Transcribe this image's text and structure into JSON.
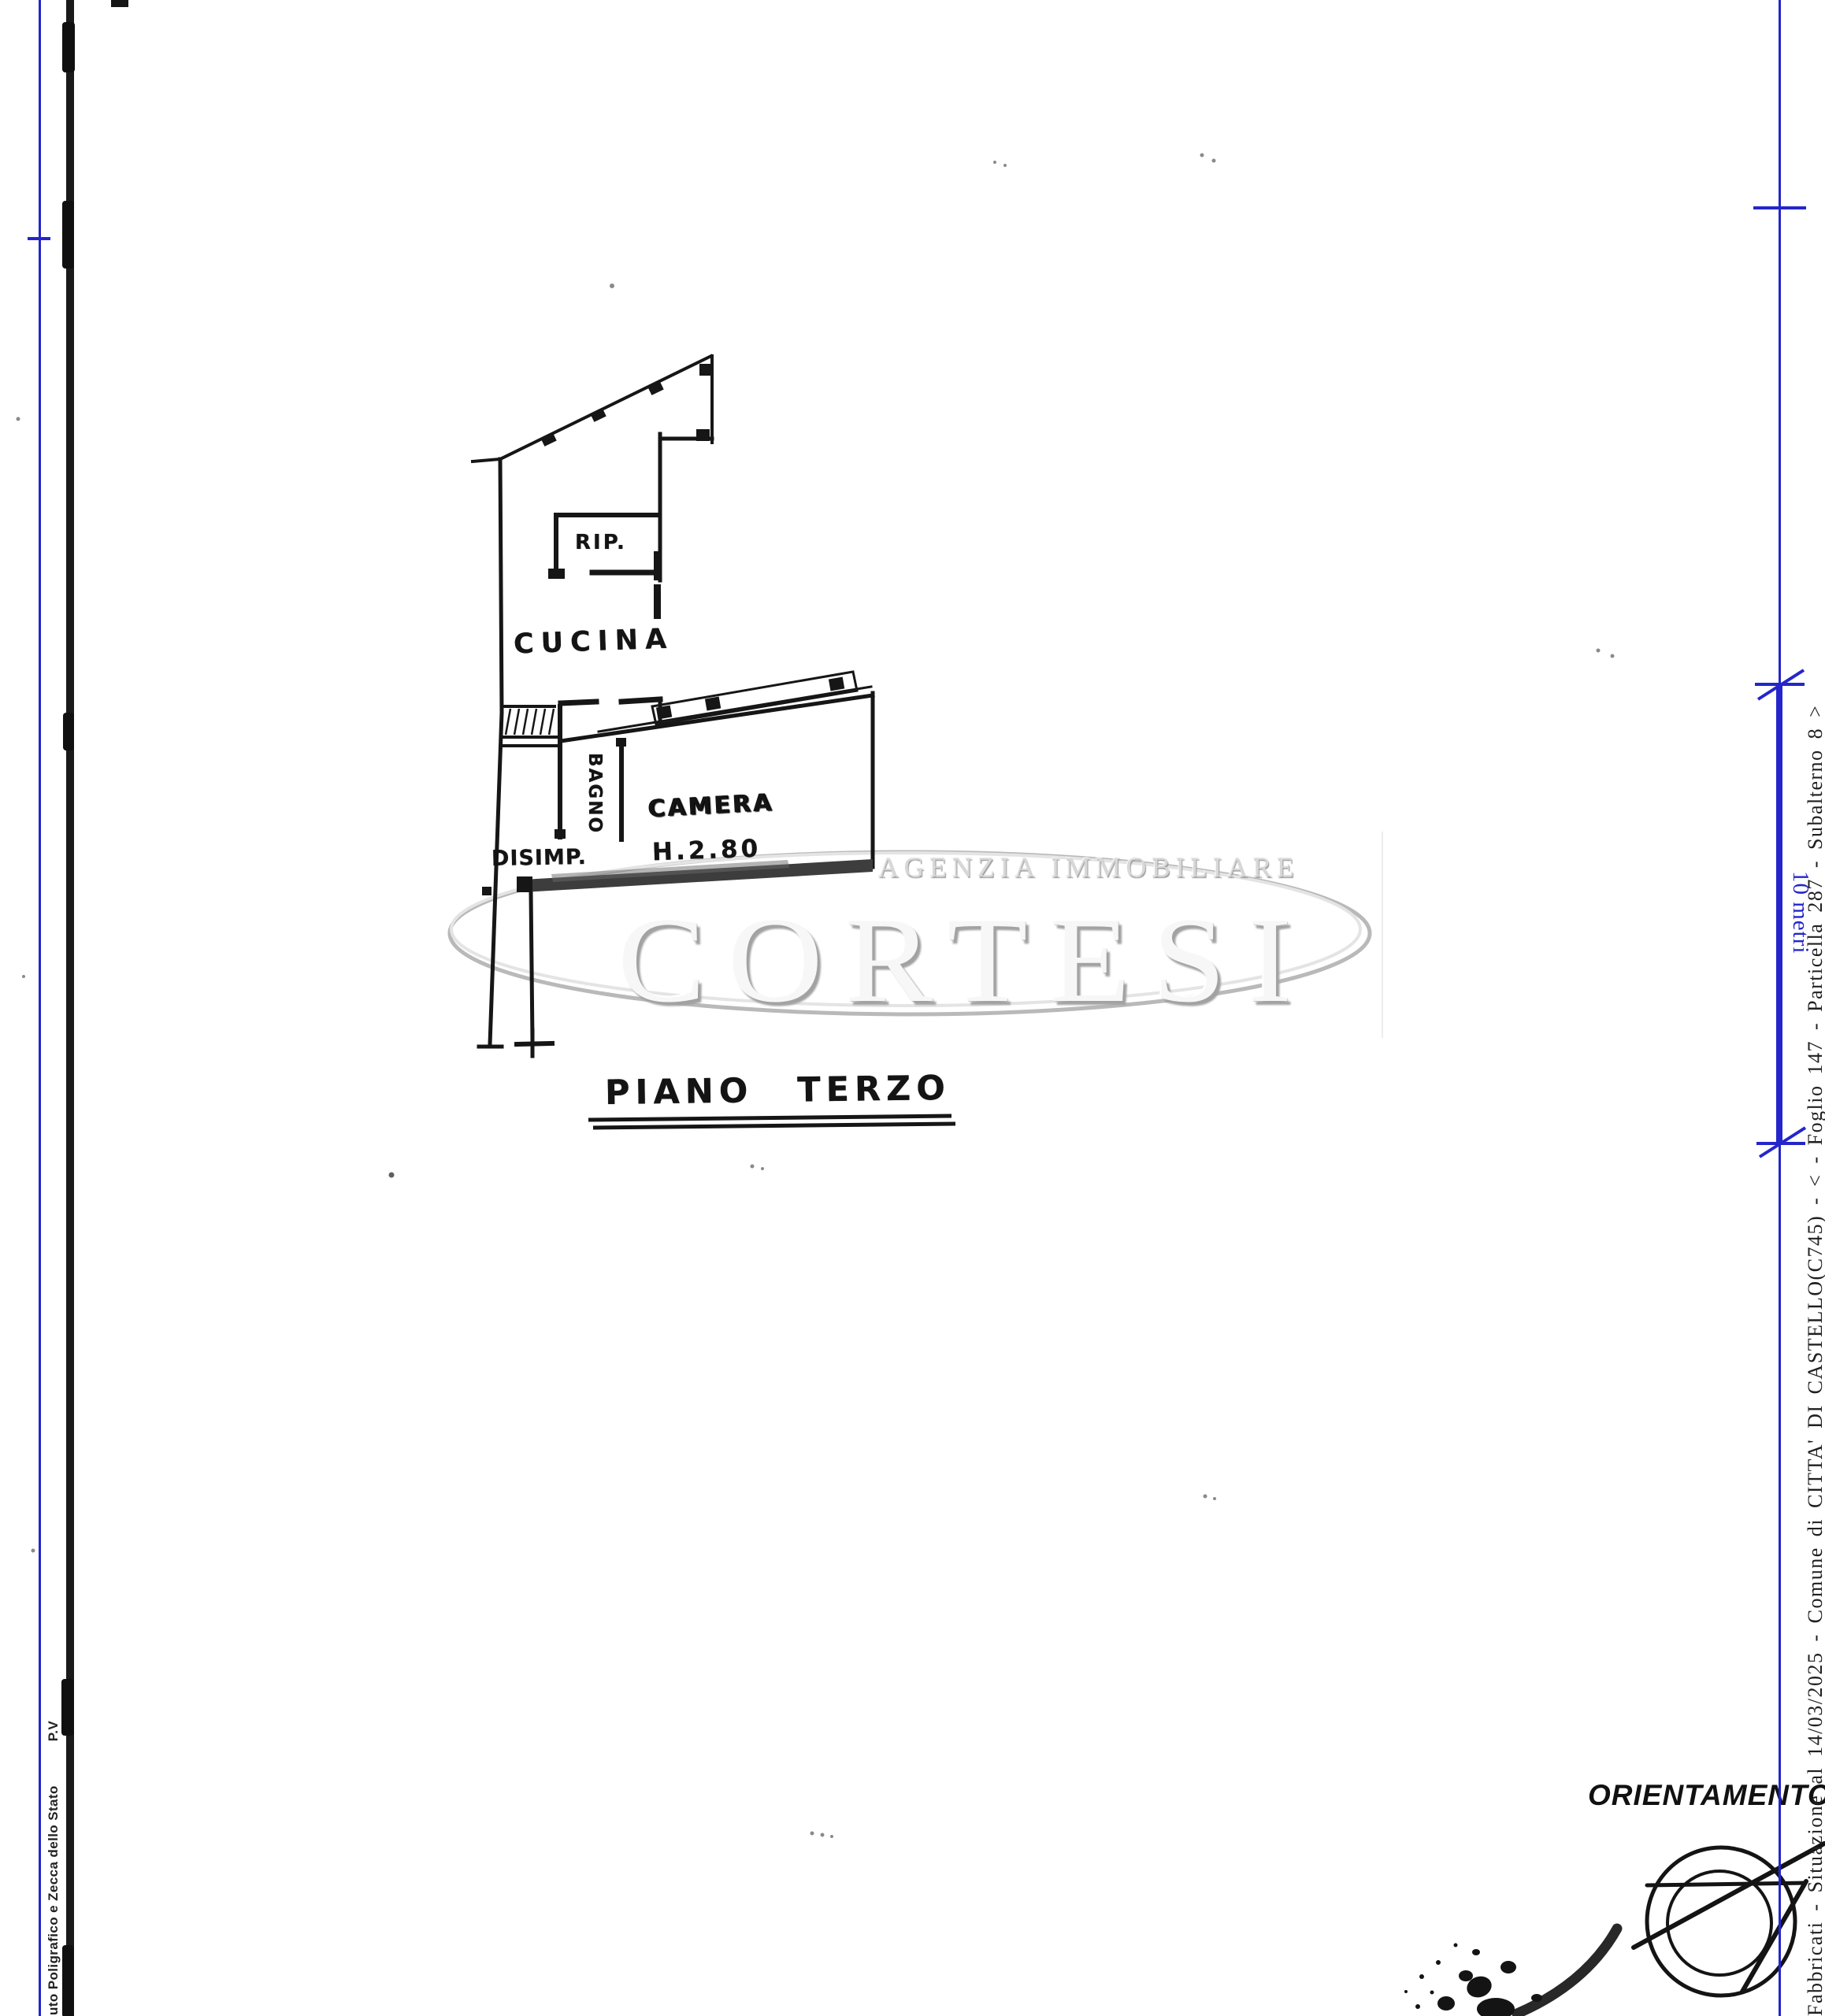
{
  "document": {
    "kind": "scanned cadastral floor plan page",
    "caption": "PIANO TERZO"
  },
  "floor_plan": {
    "rooms": {
      "rip": "RIP.",
      "cucina": "CUCINA",
      "bagno": "BAGNO",
      "disimp": "DISIMP.",
      "camera": "CAMERA"
    },
    "camera_height": "H.2.80",
    "caption": "PIANO TERZO"
  },
  "watermark": {
    "agency": "AGENZIA IMMOBILIARE",
    "brand": "CORTESI"
  },
  "margins": {
    "left_text": "uto Poligrafico e Zecca dello Stato",
    "left_text_suffix": "P.V",
    "right_text": "Fabbricati - Situazione al 14/03/2025 - Comune di CITTA' DI CASTELLO(C745) - < - Foglio 147 - Particella 287 - Subalterno 8 >",
    "scale_label": "10 metri"
  },
  "orientation": {
    "label": "ORIENTAMENTO"
  },
  "icons": {
    "compass": "orientation-compass-circle",
    "stamp": "round-ink-stamp-fragment"
  },
  "colors": {
    "registration_blue": "#2426cb",
    "ink_black": "#161616",
    "wall_shadow_gray": "#3d3d3d",
    "watermark_gray": "#b9b9b9"
  }
}
